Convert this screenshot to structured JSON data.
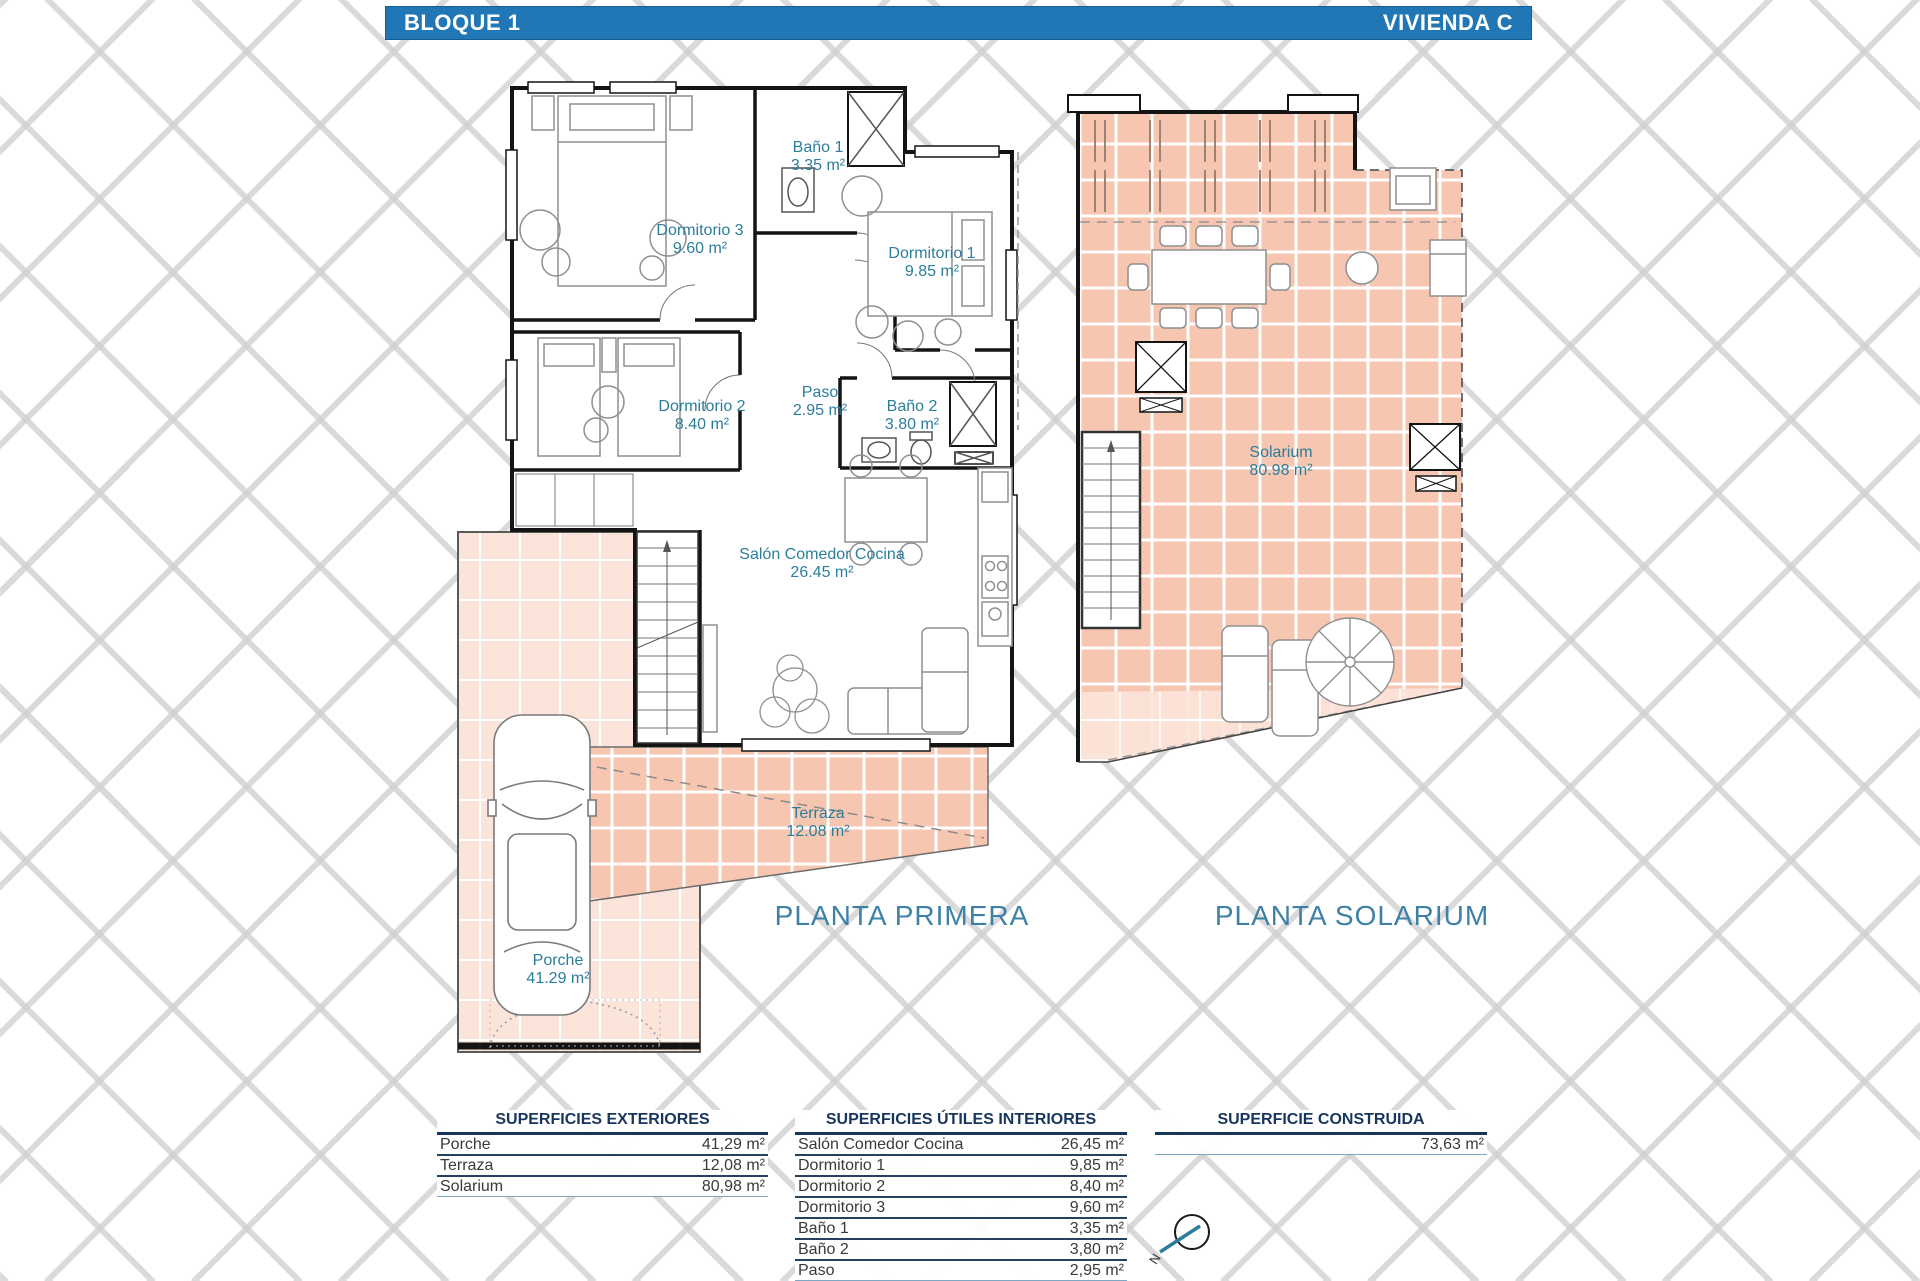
{
  "header": {
    "left": "BLOQUE 1",
    "right": "VIVIENDA C"
  },
  "plans": {
    "primera": {
      "title": "PLANTA PRIMERA",
      "rooms": [
        {
          "name": "Dormitorio 3",
          "area": "9.60 m²"
        },
        {
          "name": "Baño 1",
          "area": "3.35 m²"
        },
        {
          "name": "Dormitorio 1",
          "area": "9.85 m²"
        },
        {
          "name": "Dormitorio 2",
          "area": "8.40 m²"
        },
        {
          "name": "Paso",
          "area": "2.95 m²"
        },
        {
          "name": "Baño 2",
          "area": "3.80 m²"
        },
        {
          "name": "Salón Comedor Cocina",
          "area": "26.45 m²"
        },
        {
          "name": "Terraza",
          "area": "12.08 m²"
        },
        {
          "name": "Porche",
          "area": "41.29 m²"
        }
      ]
    },
    "solarium": {
      "title": "PLANTA SOLARIUM",
      "rooms": [
        {
          "name": "Solarium",
          "area": "80.98 m²"
        }
      ]
    }
  },
  "tables": {
    "exteriores": {
      "title": "SUPERFICIES EXTERIORES",
      "rows": [
        {
          "label": "Porche",
          "value": "41,29 m²"
        },
        {
          "label": "Terraza",
          "value": "12,08 m²"
        },
        {
          "label": "Solarium",
          "value": "80,98 m²"
        }
      ]
    },
    "interiores": {
      "title": "SUPERFICIES ÚTILES INTERIORES",
      "rows": [
        {
          "label": "Salón Comedor Cocina",
          "value": "26,45 m²"
        },
        {
          "label": "Dormitorio 1",
          "value": "9,85 m²"
        },
        {
          "label": "Dormitorio 2",
          "value": "8,40 m²"
        },
        {
          "label": "Dormitorio 3",
          "value": "9,60 m²"
        },
        {
          "label": "Baño 1",
          "value": "3,35 m²"
        },
        {
          "label": "Baño 2",
          "value": "3,80 m²"
        },
        {
          "label": "Paso",
          "value": "2,95 m²"
        }
      ]
    },
    "construida": {
      "title": "SUPERFICIE CONSTRUIDA",
      "rows": [
        {
          "label": "",
          "value": "73,63 m²"
        }
      ]
    }
  },
  "compass": {
    "label": "N"
  },
  "colors": {
    "header_bar": "#2177b5",
    "room_label_teal": "#2c7d9c",
    "plan_title_teal": "#3d81a6",
    "tile_salmon": "#f6c6b1",
    "tile_light": "#fbe4da",
    "table_rule_navy": "#24415f",
    "wall_black": "#141414"
  }
}
